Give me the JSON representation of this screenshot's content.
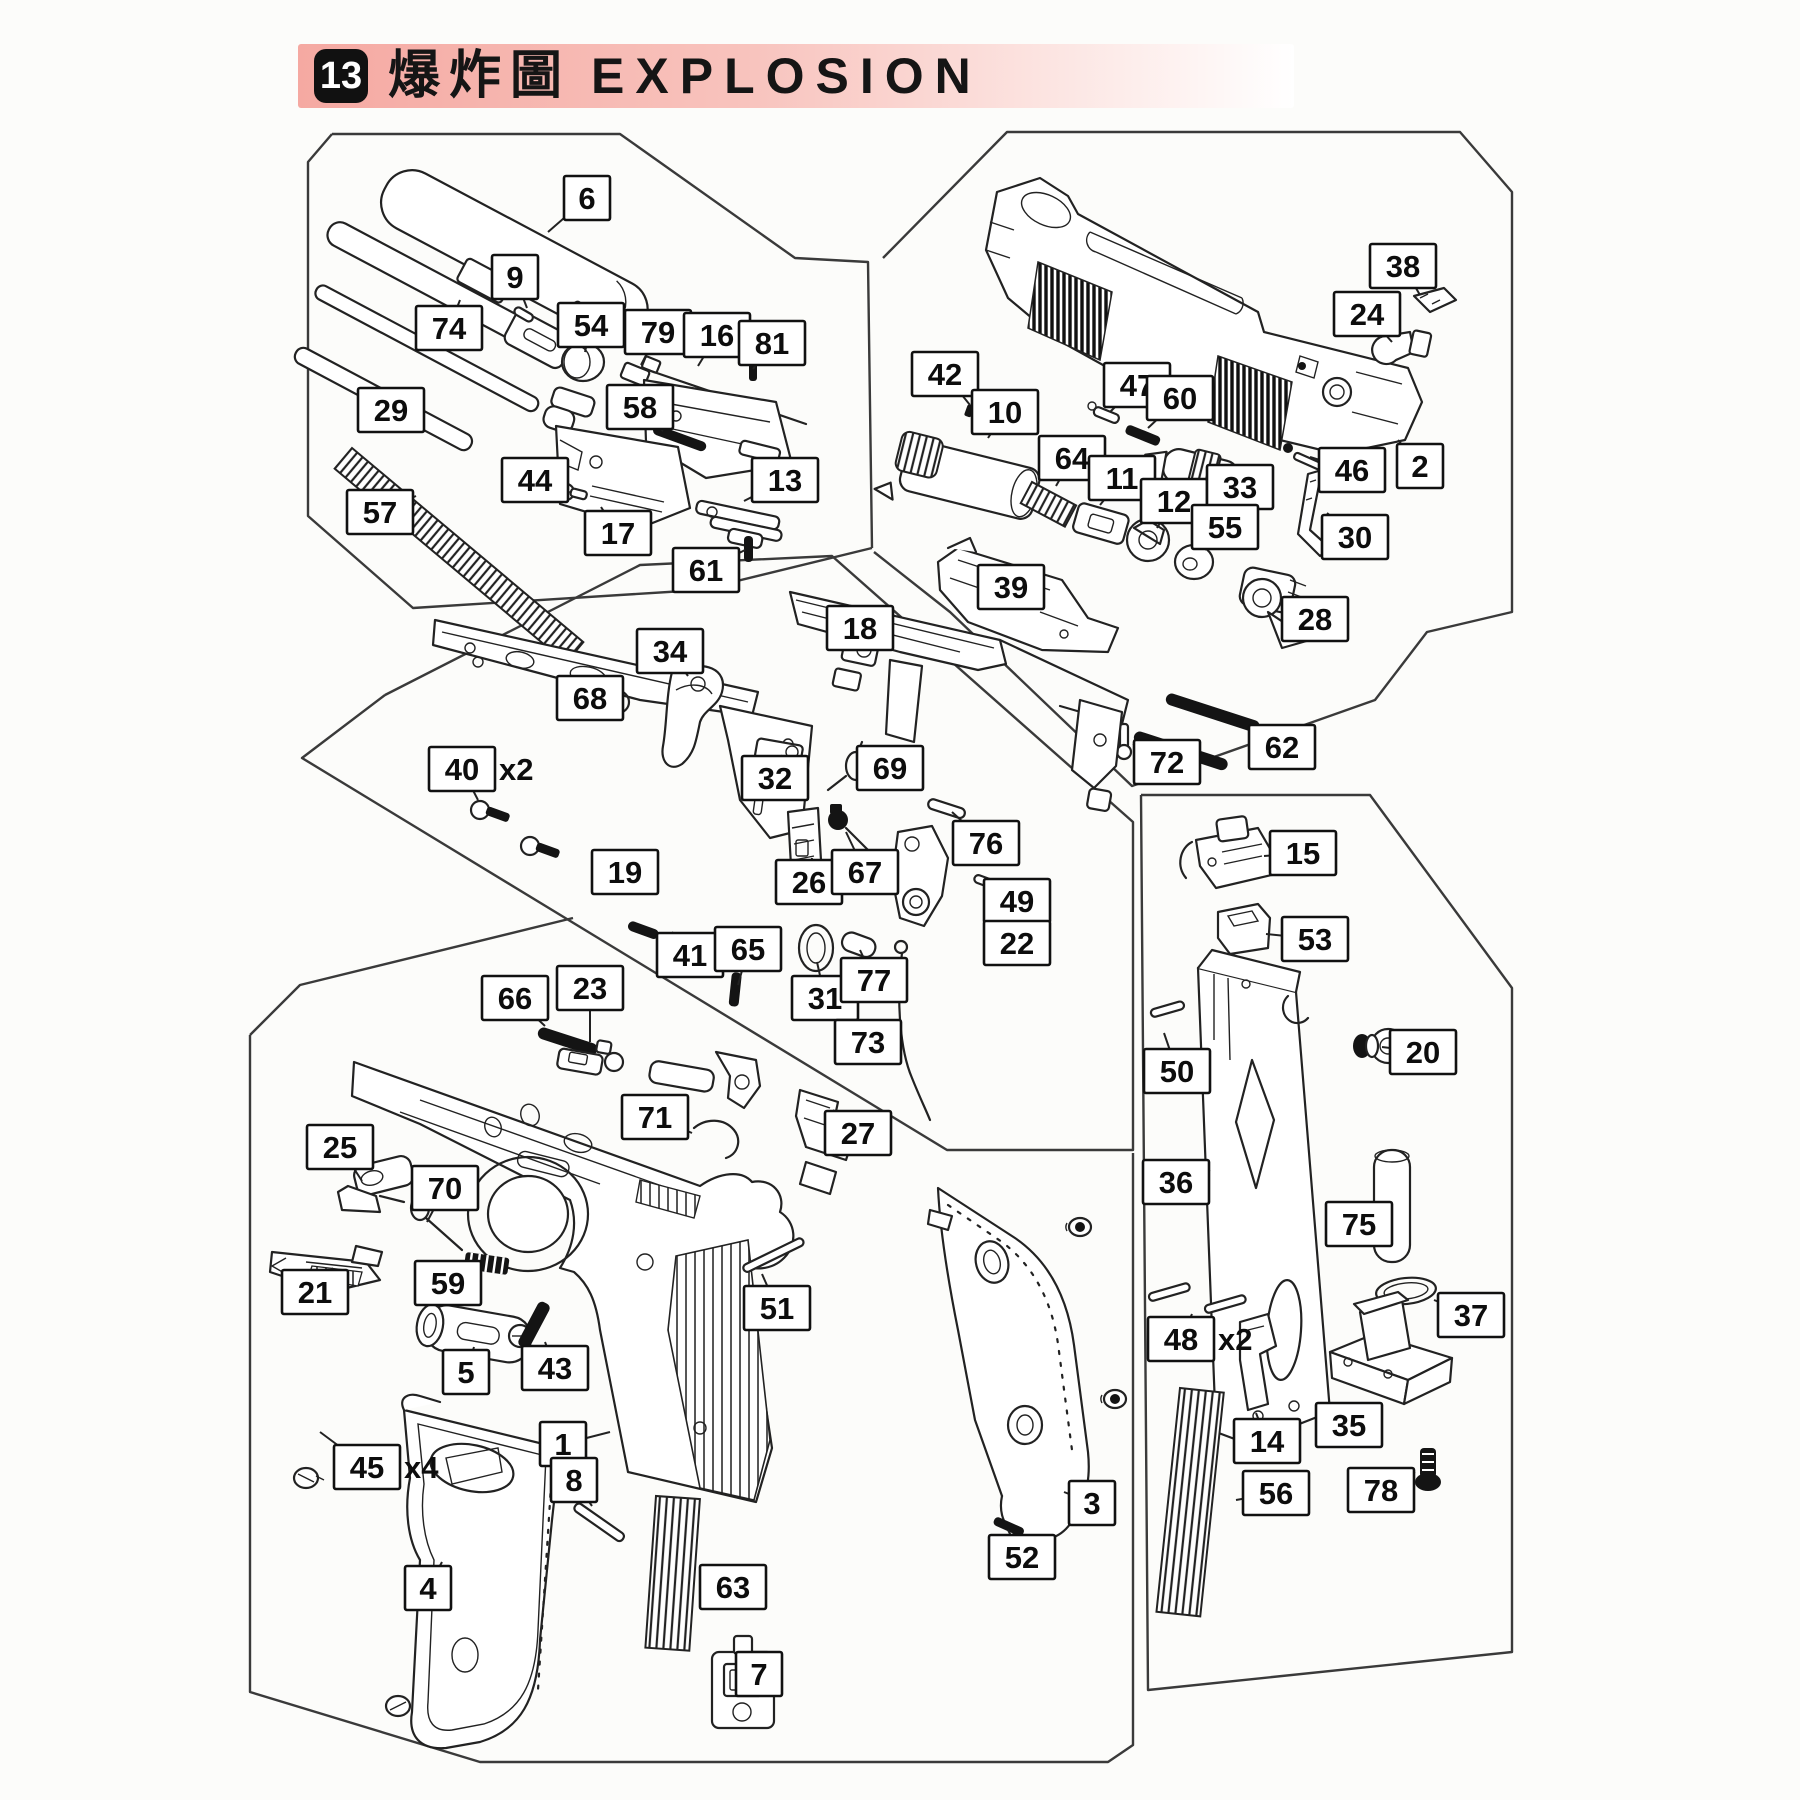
{
  "header": {
    "badge": "13",
    "title_zh": "爆炸圖",
    "title_en": "EXPLOSION"
  },
  "colors": {
    "banner_pink": "#f5a9a2",
    "paper": "#fcfcfa",
    "line": "#222222",
    "label_border": "#111111",
    "label_fill": "#ffffff"
  },
  "diagram": {
    "description": "Exploded parts diagram of a gas blowback pistol, five bordered part groups",
    "labels": [
      {
        "t": "6",
        "x": 587,
        "y": 198,
        "tx": 548,
        "ty": 232
      },
      {
        "t": "9",
        "x": 515,
        "y": 277,
        "tx": 527,
        "ty": 308
      },
      {
        "t": "74",
        "x": 449,
        "y": 328,
        "tx": 460,
        "ty": 300
      },
      {
        "t": "54",
        "x": 591,
        "y": 325,
        "tx": 585,
        "ty": 352
      },
      {
        "t": "79",
        "x": 658,
        "y": 332,
        "tx": 641,
        "ty": 365
      },
      {
        "t": "16",
        "x": 717,
        "y": 335,
        "tx": 698,
        "ty": 366
      },
      {
        "t": "81",
        "x": 772,
        "y": 343,
        "tx": 753,
        "ty": 369
      },
      {
        "t": "29",
        "x": 391,
        "y": 410,
        "tx": 424,
        "ty": 391
      },
      {
        "t": "58",
        "x": 640,
        "y": 407,
        "tx": 663,
        "ty": 431
      },
      {
        "t": "44",
        "x": 535,
        "y": 480,
        "tx": 561,
        "ty": 489
      },
      {
        "t": "13",
        "x": 785,
        "y": 480,
        "tx": 744,
        "ty": 501
      },
      {
        "t": "57",
        "x": 380,
        "y": 512,
        "tx": 416,
        "ty": 496
      },
      {
        "t": "17",
        "x": 618,
        "y": 533,
        "tx": 601,
        "ty": 507
      },
      {
        "t": "61",
        "x": 706,
        "y": 570,
        "tx": 745,
        "ty": 550
      },
      {
        "t": "38",
        "x": 1403,
        "y": 266,
        "tx": 1420,
        "ty": 295
      },
      {
        "t": "24",
        "x": 1367,
        "y": 314,
        "tx": 1392,
        "ty": 342
      },
      {
        "t": "42",
        "x": 945,
        "y": 374,
        "tx": 970,
        "ty": 405
      },
      {
        "t": "10",
        "x": 1005,
        "y": 412,
        "tx": 988,
        "ty": 438
      },
      {
        "t": "47",
        "x": 1137,
        "y": 385,
        "tx": 1110,
        "ty": 412
      },
      {
        "t": "60",
        "x": 1180,
        "y": 398,
        "tx": 1148,
        "ty": 428
      },
      {
        "t": "64",
        "x": 1072,
        "y": 458,
        "tx": 1056,
        "ty": 486
      },
      {
        "t": "11",
        "x": 1122,
        "y": 478,
        "tx": 1100,
        "ty": 505
      },
      {
        "t": "12",
        "x": 1174,
        "y": 501,
        "tx": 1157,
        "ty": 528
      },
      {
        "t": "33",
        "x": 1240,
        "y": 487,
        "tx": 1222,
        "ty": 470
      },
      {
        "t": "46",
        "x": 1352,
        "y": 470,
        "tx": 1310,
        "ty": 457
      },
      {
        "t": "2",
        "x": 1420,
        "y": 466,
        "tx": 1398,
        "ty": 440
      },
      {
        "t": "30",
        "x": 1355,
        "y": 537,
        "tx": 1327,
        "ty": 513
      },
      {
        "t": "55",
        "x": 1225,
        "y": 527,
        "tx": 1205,
        "ty": 550
      },
      {
        "t": "39",
        "x": 1011,
        "y": 587,
        "tx": 1035,
        "ty": 604
      },
      {
        "t": "28",
        "x": 1315,
        "y": 619,
        "tx": 1293,
        "ty": 612
      },
      {
        "t": "62",
        "x": 1282,
        "y": 747,
        "tx": 1258,
        "ty": 730
      },
      {
        "t": "72",
        "x": 1167,
        "y": 762,
        "tx": 1133,
        "ty": 744
      },
      {
        "t": "18",
        "x": 860,
        "y": 628,
        "tx": 838,
        "ty": 650
      },
      {
        "t": "34",
        "x": 670,
        "y": 651,
        "tx": 688,
        "ty": 676
      },
      {
        "t": "68",
        "x": 590,
        "y": 698,
        "tx": 612,
        "ty": 702
      },
      {
        "t": "40",
        "suffix": "x2",
        "x": 462,
        "y": 769,
        "tx": 478,
        "ty": 800
      },
      {
        "t": "32",
        "x": 775,
        "y": 778,
        "tx": 782,
        "ty": 755
      },
      {
        "t": "69",
        "x": 890,
        "y": 768,
        "tx": 862,
        "ty": 766
      },
      {
        "t": "19",
        "x": 625,
        "y": 872,
        "tx": 648,
        "ty": 850
      },
      {
        "t": "26",
        "x": 809,
        "y": 882,
        "tx": 812,
        "ty": 858
      },
      {
        "t": "67",
        "x": 865,
        "y": 872,
        "tx": 846,
        "ty": 832
      },
      {
        "t": "76",
        "x": 986,
        "y": 843,
        "tx": 952,
        "ty": 812
      },
      {
        "t": "49",
        "x": 1017,
        "y": 901,
        "tx": 991,
        "ty": 881
      },
      {
        "t": "22",
        "x": 1017,
        "y": 943,
        "tx": 986,
        "ty": 926
      },
      {
        "t": "31",
        "x": 825,
        "y": 998,
        "tx": 817,
        "ty": 962
      },
      {
        "t": "77",
        "x": 874,
        "y": 980,
        "tx": 860,
        "ty": 950
      },
      {
        "t": "73",
        "x": 868,
        "y": 1042,
        "tx": 899,
        "ty": 1030
      },
      {
        "t": "41",
        "x": 690,
        "y": 955,
        "tx": 672,
        "ty": 932
      },
      {
        "t": "65",
        "x": 748,
        "y": 949,
        "tx": 738,
        "ty": 985
      },
      {
        "t": "66",
        "x": 515,
        "y": 998,
        "tx": 545,
        "ty": 1026
      },
      {
        "t": "23",
        "x": 590,
        "y": 988,
        "tx": 590,
        "ty": 1042
      },
      {
        "t": "27",
        "x": 858,
        "y": 1133,
        "tx": 833,
        "ty": 1110
      },
      {
        "t": "71",
        "x": 655,
        "y": 1117,
        "tx": 692,
        "ty": 1133
      },
      {
        "t": "25",
        "x": 340,
        "y": 1147,
        "tx": 362,
        "ty": 1181
      },
      {
        "t": "70",
        "x": 445,
        "y": 1188,
        "tx": 427,
        "ty": 1222
      },
      {
        "t": "21",
        "x": 315,
        "y": 1292,
        "tx": 333,
        "ty": 1268
      },
      {
        "t": "59",
        "x": 448,
        "y": 1283,
        "tx": 477,
        "ty": 1282
      },
      {
        "t": "5",
        "x": 466,
        "y": 1372,
        "tx": 474,
        "ty": 1347
      },
      {
        "t": "43",
        "x": 555,
        "y": 1368,
        "tx": 545,
        "ty": 1342
      },
      {
        "t": "1",
        "x": 563,
        "y": 1444,
        "tx": 610,
        "ty": 1432
      },
      {
        "t": "51",
        "x": 777,
        "y": 1308,
        "tx": 762,
        "ty": 1274
      },
      {
        "t": "45",
        "suffix": "x4",
        "x": 367,
        "y": 1467,
        "tx": 320,
        "ty": 1432
      },
      {
        "t": "8",
        "x": 574,
        "y": 1480,
        "tx": 592,
        "ty": 1506
      },
      {
        "t": "4",
        "x": 428,
        "y": 1588,
        "tx": 442,
        "ty": 1562
      },
      {
        "t": "63",
        "x": 733,
        "y": 1587,
        "tx": 702,
        "ty": 1572
      },
      {
        "t": "7",
        "x": 759,
        "y": 1674,
        "tx": 740,
        "ty": 1690
      },
      {
        "t": "3",
        "x": 1092,
        "y": 1503,
        "tx": 1064,
        "ty": 1492
      },
      {
        "t": "52",
        "x": 1022,
        "y": 1557,
        "tx": 1008,
        "ty": 1530
      },
      {
        "t": "15",
        "x": 1303,
        "y": 853,
        "tx": 1264,
        "ty": 856
      },
      {
        "t": "53",
        "x": 1315,
        "y": 939,
        "tx": 1266,
        "ty": 934
      },
      {
        "t": "50",
        "x": 1177,
        "y": 1071,
        "tx": 1164,
        "ty": 1033
      },
      {
        "t": "20",
        "x": 1423,
        "y": 1052,
        "tx": 1382,
        "ty": 1047
      },
      {
        "t": "36",
        "x": 1176,
        "y": 1182,
        "tx": 1210,
        "ty": 1170
      },
      {
        "t": "75",
        "x": 1359,
        "y": 1224,
        "tx": 1380,
        "ty": 1233
      },
      {
        "t": "48",
        "suffix": "x2",
        "x": 1181,
        "y": 1339,
        "tx": 1192,
        "ty": 1314
      },
      {
        "t": "14",
        "x": 1267,
        "y": 1441,
        "tx": 1256,
        "ty": 1413
      },
      {
        "t": "37",
        "x": 1471,
        "y": 1315,
        "tx": 1434,
        "ty": 1300
      },
      {
        "t": "35",
        "x": 1349,
        "y": 1425,
        "tx": 1374,
        "ty": 1407
      },
      {
        "t": "56",
        "x": 1276,
        "y": 1493,
        "tx": 1236,
        "ty": 1500
      },
      {
        "t": "78",
        "x": 1381,
        "y": 1490,
        "tx": 1415,
        "ty": 1472
      }
    ]
  }
}
